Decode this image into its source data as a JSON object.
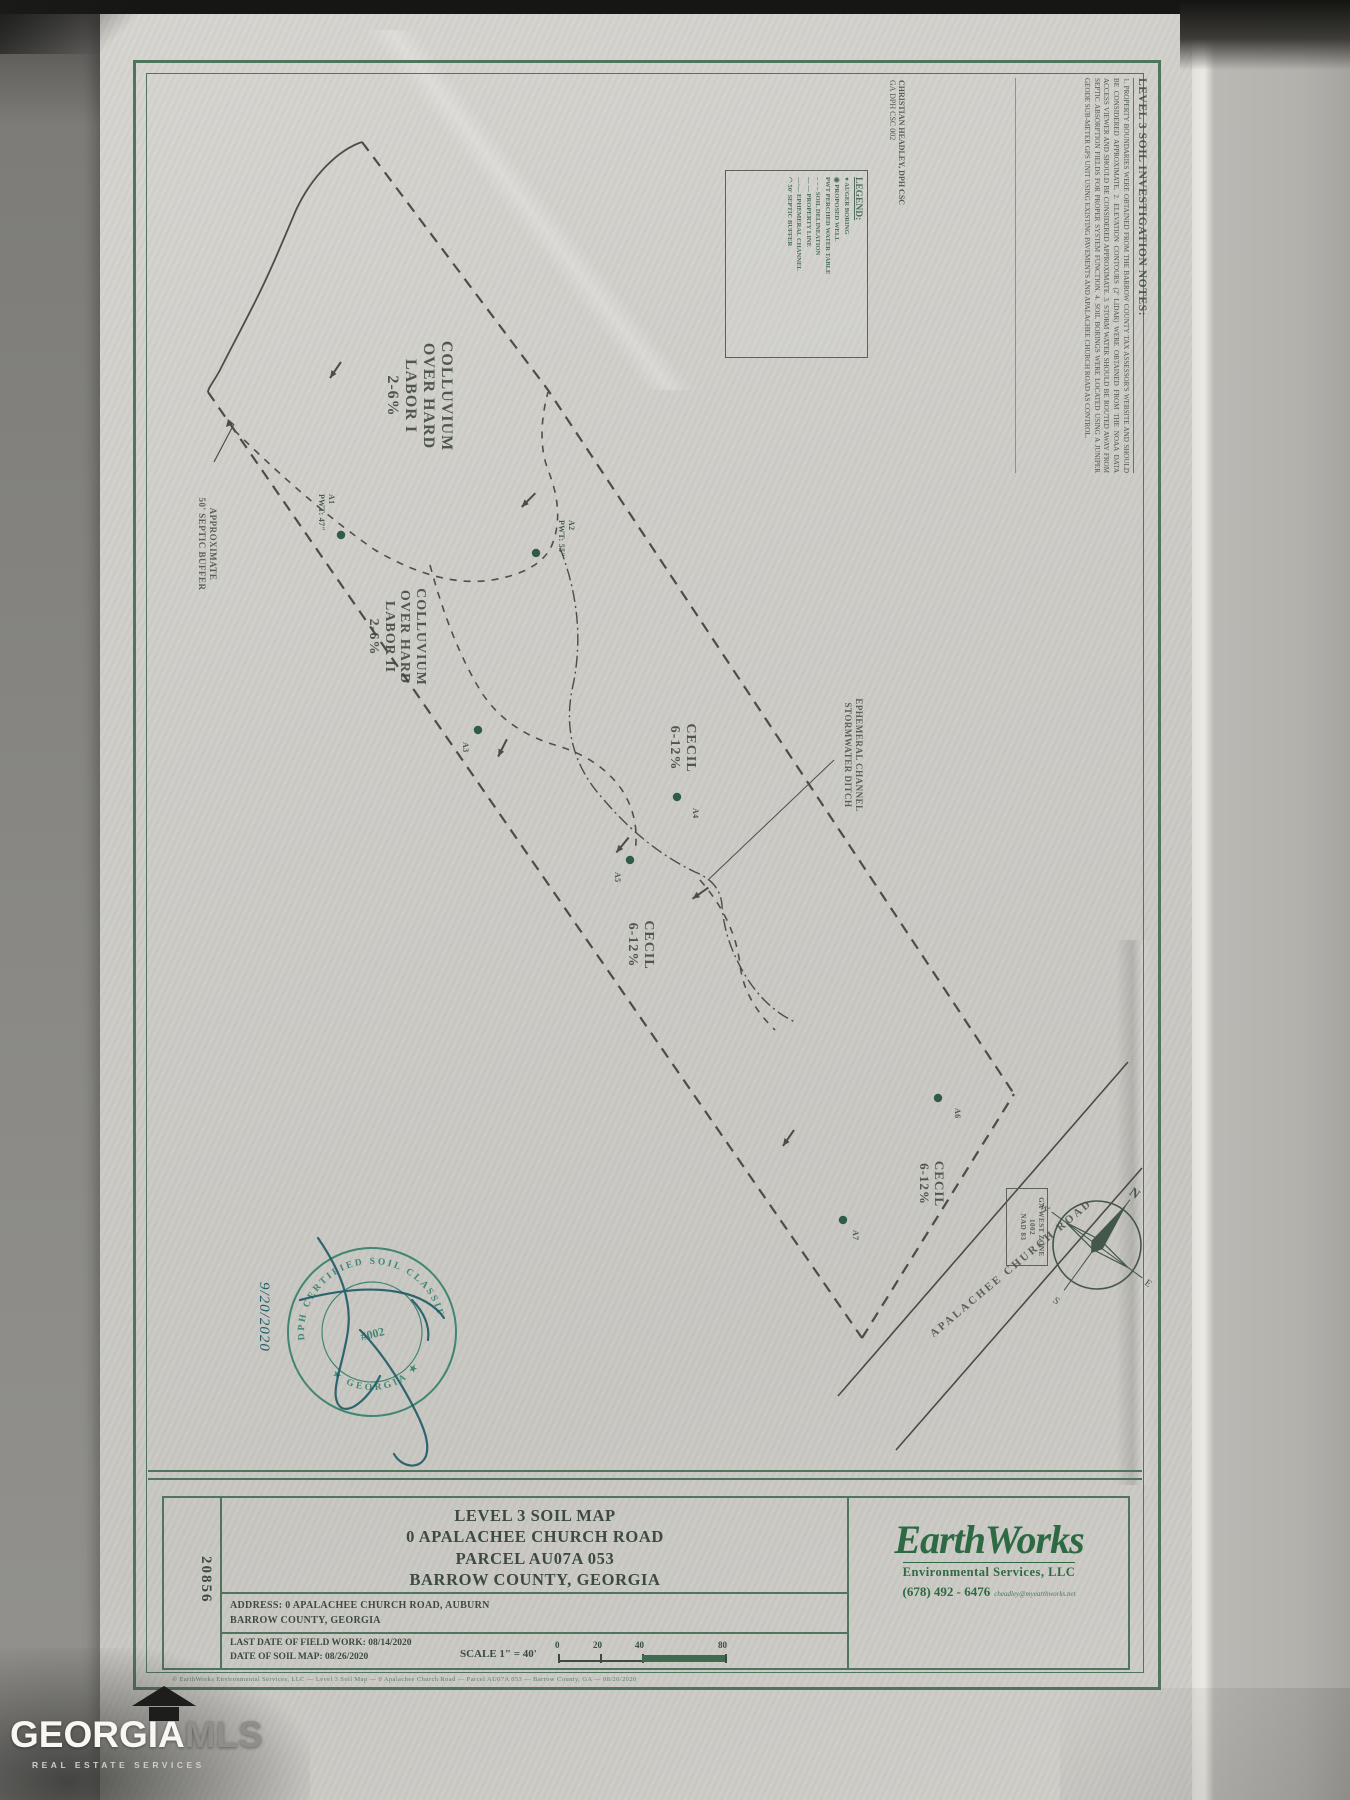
{
  "notes_panel": {
    "title": "LEVEL 3 SOIL INVESTIGATION NOTES:",
    "body": "1. PROPERTY BOUNDARIES WERE OBTAINED FROM THE BARROW COUNTY TAX ASSESSOR'S WEBSITE AND SHOULD BE CONSIDERED APPROXIMATE.  2. ELEVATION CONTOURS (2' LIDAR) WERE OBTAINED FROM THE NOAA DATA ACCESS VIEWER AND SHOULD BE CONSIDERED APPROXIMATE.  3. STORM WATER SHOULD BE ROUTED AWAY FROM SEPTIC ABSORPTION FIELDS FOR PROPER SYSTEM FUNCTION.  4. SOIL BORINGS WERE LOCATED USING A JUNIPER GEODE SUB-METER GPS UNIT USING EXISTING PAVEMENTS AND APALACHEE CHURCH ROAD AS CONTROL.",
    "prepared_by_1": "CHRISTIAN HEADLEY, DPH CSC",
    "prepared_by_2": "GA DPH CSC 002"
  },
  "legend": {
    "title": "LEGEND:",
    "items": [
      "●  AUGER BORING",
      "◉  PROPOSED WELL",
      "PWT  PERCHED WATER TABLE",
      "– – –  SOIL DELINEATION",
      "— —  PROPERTY LINE",
      "—·—  EPHEMERAL CHANNEL",
      "◠  50' SEPTIC BUFFER"
    ]
  },
  "map": {
    "soil_areas": [
      {
        "lines": [
          "COLLUVIUM",
          "OVER HARD",
          "LABOR I",
          "2-6%"
        ]
      },
      {
        "lines": [
          "COLLUVIUM",
          "OVER HARD",
          "LABOR II",
          "2-6%"
        ]
      },
      {
        "lines": [
          "CECIL",
          "6-12%"
        ]
      },
      {
        "lines": [
          "CECIL",
          "6-12%"
        ]
      },
      {
        "lines": [
          "CECIL",
          "6-12%"
        ]
      }
    ],
    "borings": [
      {
        "id": "A1",
        "note": "PWT: 47\""
      },
      {
        "id": "A2",
        "note": "PWT: 55\""
      },
      {
        "id": "A3",
        "note": ""
      },
      {
        "id": "A4",
        "note": ""
      },
      {
        "id": "A5",
        "note": ""
      },
      {
        "id": "A6",
        "note": ""
      },
      {
        "id": "A7",
        "note": ""
      }
    ],
    "septic_buffer_label": [
      "APPROXIMATE",
      "50' SEPTIC BUFFER"
    ],
    "channel_label": [
      "EPHEMERAL CHANNEL",
      "STORMWATER DITCH"
    ],
    "road_label": "APALACHEE CHURCH ROAD",
    "projection_label": [
      "GA WEST ZONE 1002",
      "NAD 83"
    ],
    "compass": {
      "n": "N",
      "e": "E",
      "s": "S",
      "w": "W"
    }
  },
  "seal": {
    "ring_top": "DPH CERTIFIED SOIL CLASSIFIER",
    "ring_bottom": "★ GEORGIA ★",
    "center": "#002",
    "handwritten_date": "9/20/2020"
  },
  "title_block": {
    "sheet_number": "20856",
    "title_line_1": "LEVEL 3 SOIL MAP",
    "title_line_2": "0 APALACHEE CHURCH ROAD",
    "title_line_3": "PARCEL AU07A 053",
    "title_line_4": "BARROW COUNTY, GEORGIA",
    "address_line_1": "ADDRESS: 0 APALACHEE CHURCH ROAD, AUBURN",
    "address_line_2": "BARROW COUNTY, GEORGIA",
    "field_work_line": "LAST DATE OF FIELD WORK: 08/14/2020",
    "map_date_line": "DATE OF SOIL MAP: 08/26/2020",
    "scale_label": "SCALE 1\" = 40'",
    "scale_ticks": [
      "0",
      "20",
      "40",
      "80"
    ],
    "company": {
      "name": "EarthWorks",
      "subtitle": "Environmental Services, LLC",
      "phone": "(678) 492 - 6476",
      "email": "cheadley@myearthworks.net"
    },
    "fine_print": "© EarthWorks Environmental Services, LLC — Level 3 Soil Map — 0 Apalachee Church Road — Parcel AU07A 053 — Barrow County, GA — 08/26/2020"
  },
  "watermark": {
    "brand_primary": "GEORGIA",
    "brand_secondary": "MLS",
    "tagline": "REAL ESTATE SERVICES"
  },
  "colors": {
    "frame_green": "#51745c",
    "ink_dark": "#4d4d46",
    "seal_teal": "#2f7d68",
    "signature_teal": "#1d5a66",
    "logo_green": "#2d6a43",
    "paper": "#cdccc7"
  }
}
